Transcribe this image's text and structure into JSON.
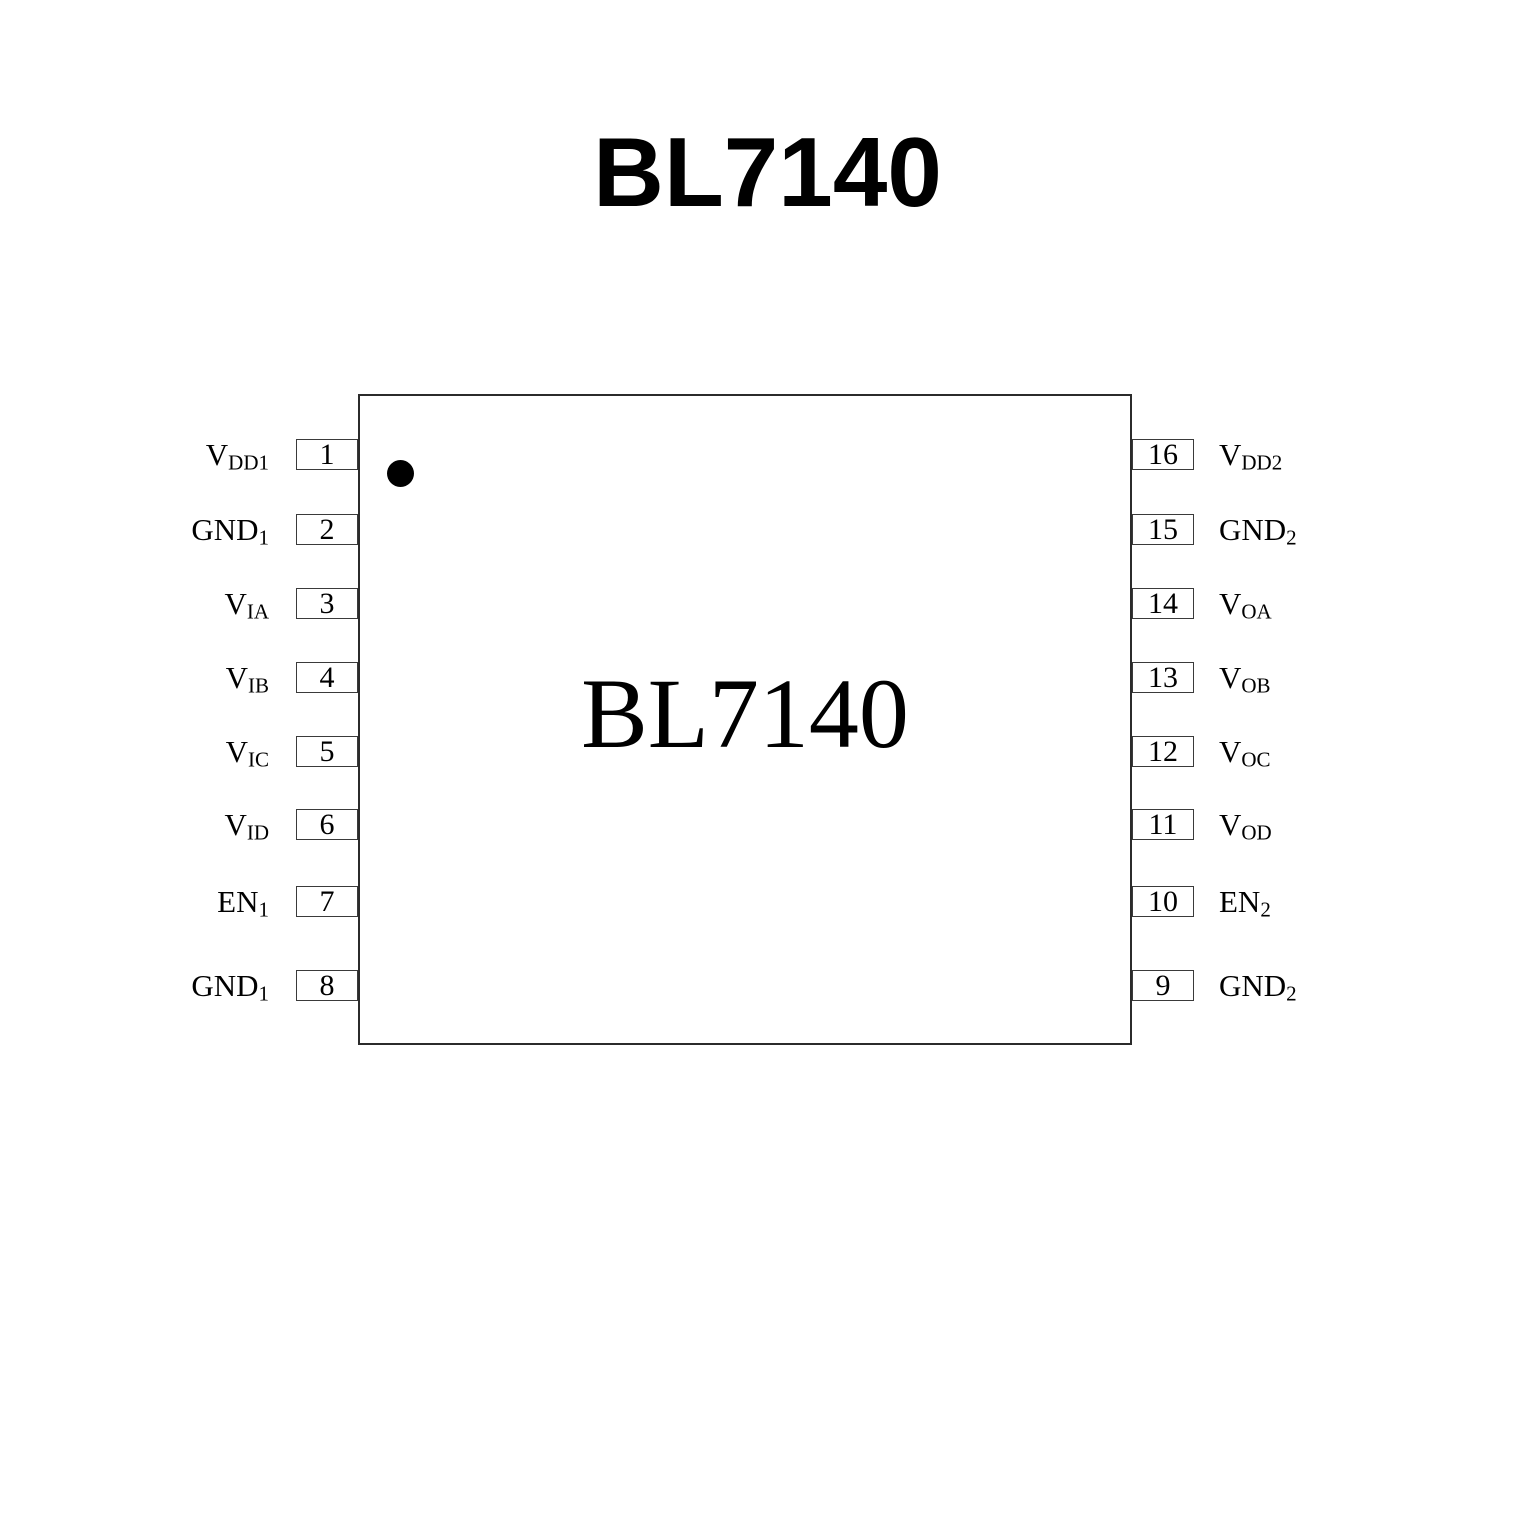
{
  "page_title": "BL7140",
  "colors": {
    "ink": "#000000",
    "background": "#ffffff",
    "body_outline": "#2b2b2b",
    "pin_box_outline": "#3a3a3a"
  },
  "chip": {
    "label": "BL7140",
    "pin1_marker": "filled-circle",
    "left_pins": [
      {
        "number": "1",
        "name": "V",
        "sub": "DD1"
      },
      {
        "number": "2",
        "name": "GND",
        "sub": "1"
      },
      {
        "number": "3",
        "name": "V",
        "sub": "IA"
      },
      {
        "number": "4",
        "name": "V",
        "sub": "IB"
      },
      {
        "number": "5",
        "name": "V",
        "sub": "IC"
      },
      {
        "number": "6",
        "name": "V",
        "sub": "ID"
      },
      {
        "number": "7",
        "name": "EN",
        "sub": "1"
      },
      {
        "number": "8",
        "name": "GND",
        "sub": "1"
      }
    ],
    "right_pins": [
      {
        "number": "16",
        "name": "V",
        "sub": "DD2"
      },
      {
        "number": "15",
        "name": "GND",
        "sub": "2"
      },
      {
        "number": "14",
        "name": "V",
        "sub": "OA"
      },
      {
        "number": "13",
        "name": "V",
        "sub": "OB"
      },
      {
        "number": "12",
        "name": "V",
        "sub": "OC"
      },
      {
        "number": "11",
        "name": "V",
        "sub": "OD"
      },
      {
        "number": "10",
        "name": "EN",
        "sub": "2"
      },
      {
        "number": "9",
        "name": "GND",
        "sub": "2"
      }
    ]
  }
}
